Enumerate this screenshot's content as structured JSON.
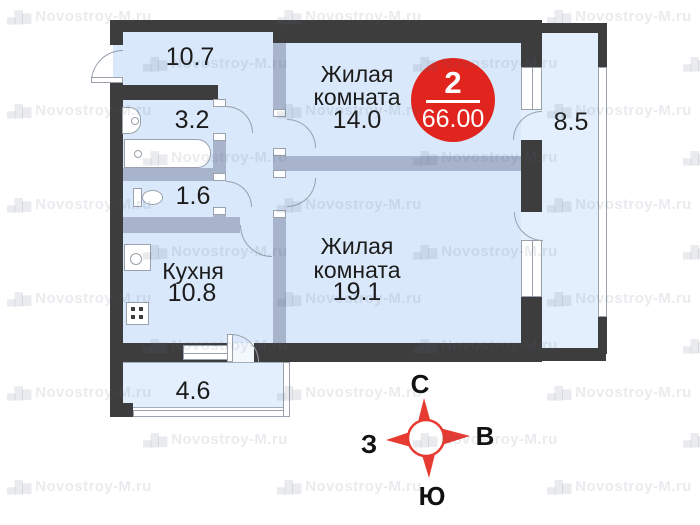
{
  "plan": {
    "rooms": {
      "hallway": {
        "area": "10.7"
      },
      "bathroom": {
        "area": "3.2"
      },
      "toilet": {
        "area": "1.6"
      },
      "kitchen": {
        "label": "Кухня",
        "area": "10.8"
      },
      "living1": {
        "label1": "Жилая",
        "label2": "комната",
        "area": "14.0"
      },
      "living2": {
        "label1": "Жилая",
        "label2": "комната",
        "area": "19.1"
      },
      "balcony_side": {
        "area": "8.5"
      },
      "balcony_bottom": {
        "area": "4.6"
      }
    },
    "badge": {
      "rooms_count": "2",
      "total_area": "66.00"
    },
    "compass": {
      "north": "С",
      "east": "В",
      "south": "Ю",
      "west": "З"
    },
    "watermark": {
      "icon": "buildings-icon",
      "icon_glyph": "▄█▆",
      "text": "Novostroy-M.ru"
    }
  },
  "colors": {
    "wall": "#3d3d3d",
    "part": "#a7b4cb",
    "roomfill": "#d9e8fa",
    "balcfill": "#e3effc",
    "outline": "#98a1ac",
    "text": "#1c1c1c",
    "badgered": "#e1241e",
    "compassred": "#e73a30",
    "wm": "rgba(88,104,122,0.13)"
  },
  "watermark_grid": {
    "row0_y": 8,
    "row_step": 47,
    "rows": 11,
    "col_step": 270,
    "even_x0": 7,
    "odd_x0": 143,
    "cols": 3
  }
}
